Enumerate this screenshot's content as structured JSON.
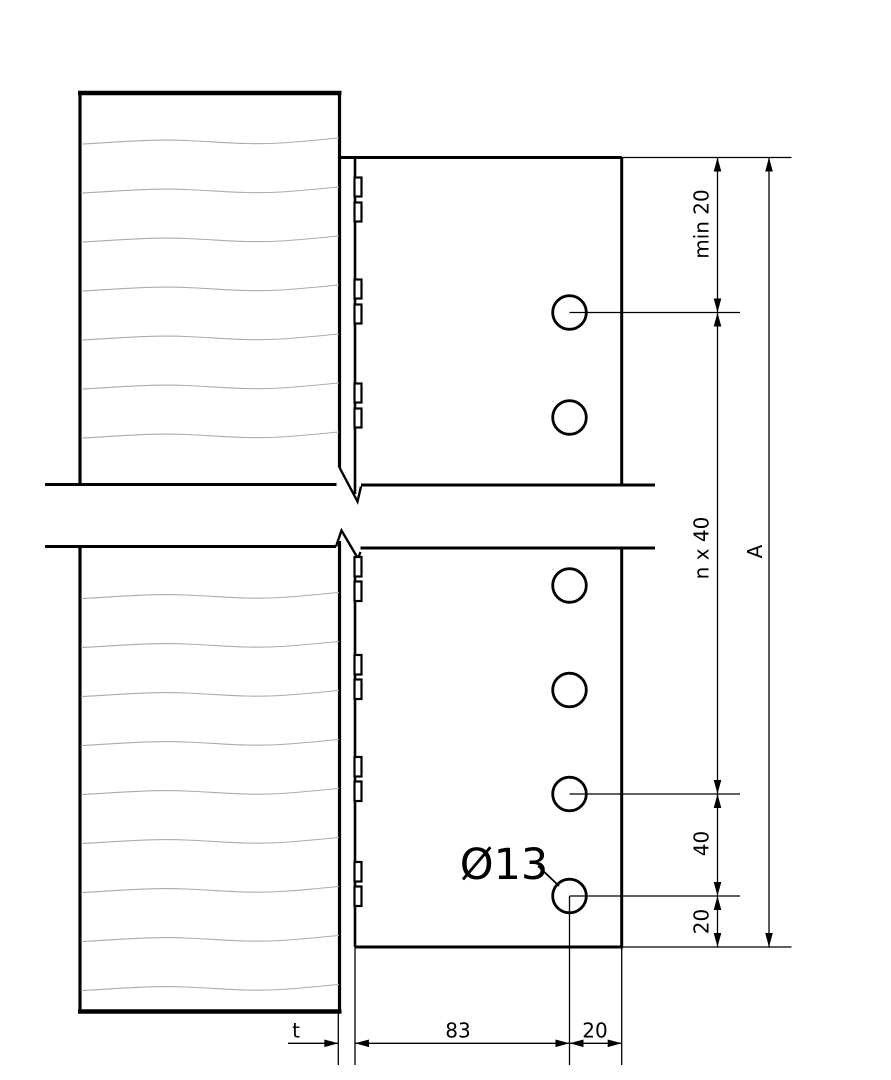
{
  "drawing": {
    "background": "#ffffff",
    "line_color": "#000000",
    "grain_color": "#ababab",
    "labels": {
      "min_edge_distance_top": "min 20",
      "bolt_spacing_pattern": "n x 40",
      "total_height": "A",
      "spacing_40": "40",
      "bottom_edge_distance": "20",
      "plate_thickness": "t",
      "horizontal_83": "83",
      "horizontal_20": "20",
      "hole_diameter": "Ø13"
    }
  }
}
